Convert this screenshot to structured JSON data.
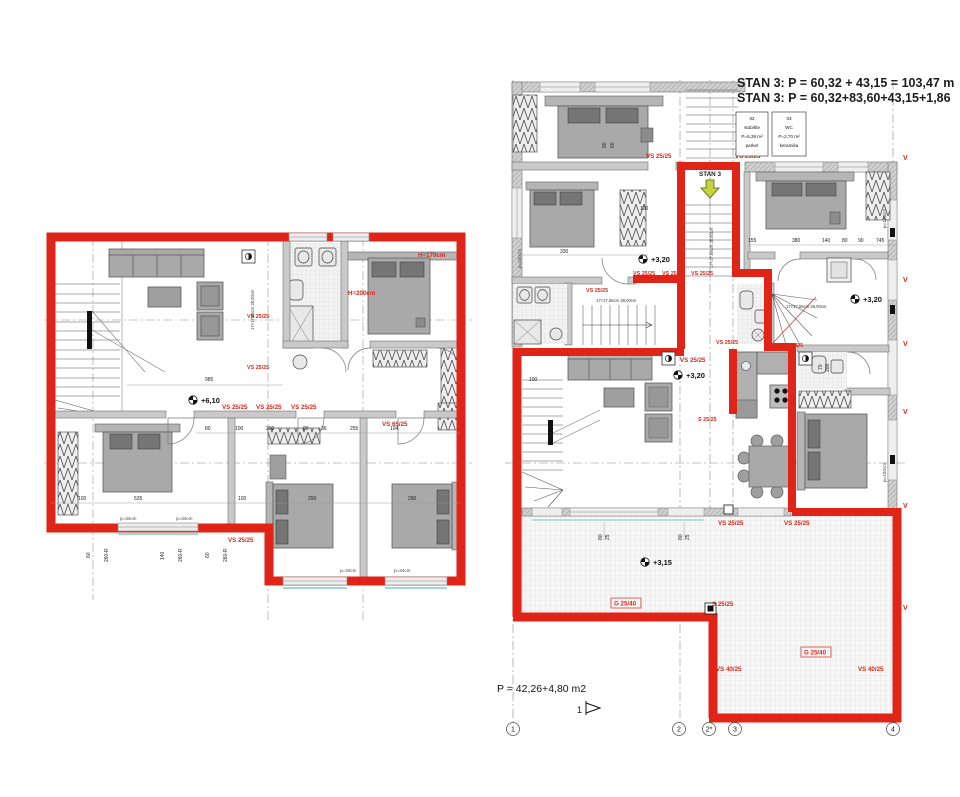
{
  "title": {
    "line1": "STAN 3: P = 60,32 + 43,15 = 103,47 m",
    "line2": "STAN 3: P = 60,32+83,60+43,15+1,86"
  },
  "room_boxes": {
    "stubiste": {
      "num": "02",
      "name": "stubište",
      "area": "P=6,39 m²",
      "floor": "parket"
    },
    "wc": {
      "num": "03",
      "name": "WC",
      "area": "P=2,70 m²",
      "floor": "keramika"
    }
  },
  "labels": {
    "vs2525": "VS 25/25",
    "vs6525": "VS 65/25",
    "vs4025": "VS 40/25",
    "s2525": "S 25/25",
    "g2540": "G 25/40",
    "v": "V",
    "stan3": "STAN 3"
  },
  "levels": {
    "l610": "+6,10",
    "l320": "+3,20",
    "l315": "+3,15"
  },
  "heights": {
    "h170": "H=170cm",
    "h200": "H=200cm"
  },
  "parapets": {
    "p34": "p=34cm",
    "p100": "p=100cm"
  },
  "stair_note": "17×17,65cm 28,00cm",
  "area_note": "P = 42,26+4,80 m2",
  "section_marker": "1",
  "grid_bubbles": [
    "1",
    "2",
    "2*",
    "3",
    "4"
  ],
  "dims": [
    "985",
    "535",
    "100",
    "290",
    "80",
    "200",
    "255",
    "140",
    "36",
    "120",
    "330",
    "380",
    "745",
    "90",
    "50",
    "60",
    "260-R",
    "300",
    "70",
    "104",
    "155",
    "25"
  ]
}
